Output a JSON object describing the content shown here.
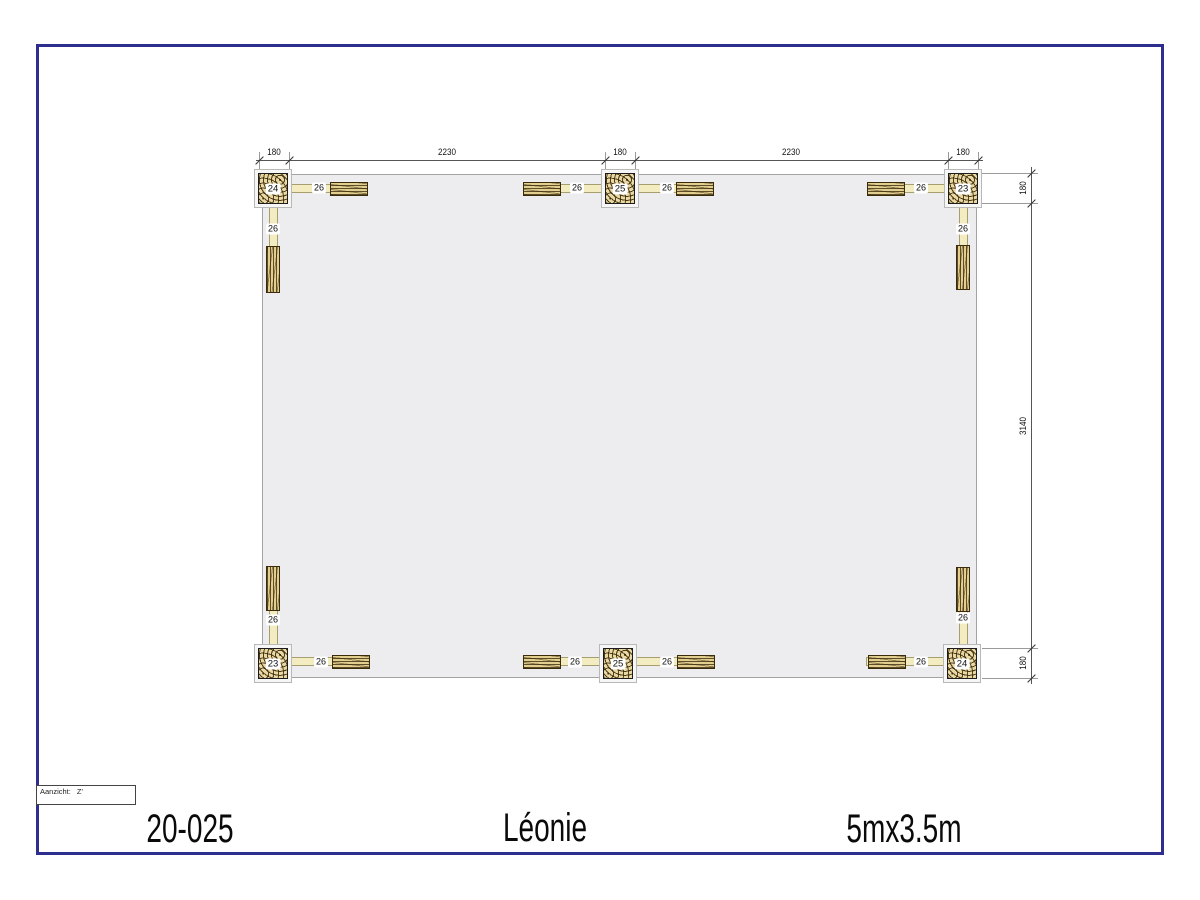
{
  "drawing": {
    "number": "20-025",
    "name": "Léonie",
    "size": "5mx3.5m"
  },
  "view_box": {
    "label": "Aanzicht:",
    "value": "Z'"
  },
  "plan": {
    "dims_top": [
      "180",
      "2230",
      "180",
      "2230",
      "180"
    ],
    "dims_right": [
      "180",
      "3140",
      "180"
    ],
    "posts": [
      {
        "position": "top-left",
        "label": "24"
      },
      {
        "position": "top-middle",
        "label": "25"
      },
      {
        "position": "top-right",
        "label": "23"
      },
      {
        "position": "bottom-left",
        "label": "23"
      },
      {
        "position": "bottom-middle",
        "label": "25"
      },
      {
        "position": "bottom-right",
        "label": "24"
      }
    ],
    "beams": [
      {
        "position": "top-left",
        "label": "26"
      },
      {
        "position": "top-left-of-middle",
        "label": "26"
      },
      {
        "position": "top-right-of-middle",
        "label": "26"
      },
      {
        "position": "top-right",
        "label": "26"
      },
      {
        "position": "bottom-left",
        "label": "26"
      },
      {
        "position": "bottom-left-of-middle",
        "label": "26"
      },
      {
        "position": "bottom-right-of-middle",
        "label": "26"
      },
      {
        "position": "bottom-right",
        "label": "26"
      },
      {
        "position": "side-left-top",
        "label": "26"
      },
      {
        "position": "side-right-top",
        "label": "26"
      },
      {
        "position": "side-left-bottom",
        "label": "26"
      },
      {
        "position": "side-right-bottom",
        "label": "26"
      }
    ],
    "colors": {
      "frame_border": "#2e2e8e",
      "floor_fill": "#ededef",
      "beam_fill": "#f4ecc1",
      "wood_base": "#e9d8a1",
      "wood_grain": "#3a2c0a"
    }
  }
}
